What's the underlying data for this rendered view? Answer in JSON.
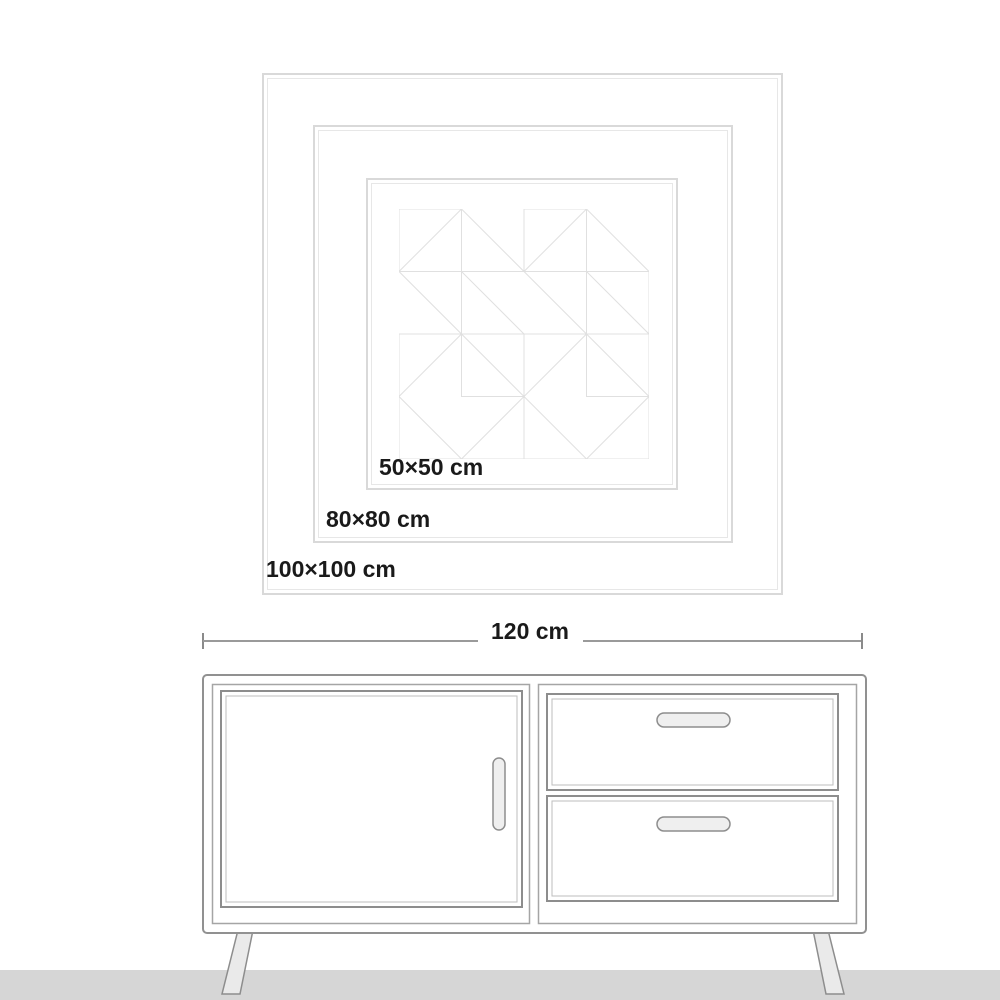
{
  "art": {
    "description": "wall-art size comparison with nested frames and geometric triangle pattern",
    "sizes": [
      {
        "label": "50×50 cm"
      },
      {
        "label": "80×80 cm"
      },
      {
        "label": "100×100 cm"
      }
    ]
  },
  "cabinet": {
    "description": "sideboard with one door (left) and two drawers (right) on splayed legs",
    "width_label": "120 cm"
  },
  "colors": {
    "frame_line": "#d9d9d9",
    "frame_inner_line": "#e7e7e7",
    "pattern_line": "#e0e0e0",
    "dimension_line": "#9a9a9a",
    "cabinet_outline": "#8f8f8f",
    "floor": "#d6d6d6",
    "text": "#1a1a1a",
    "background": "#ffffff"
  }
}
